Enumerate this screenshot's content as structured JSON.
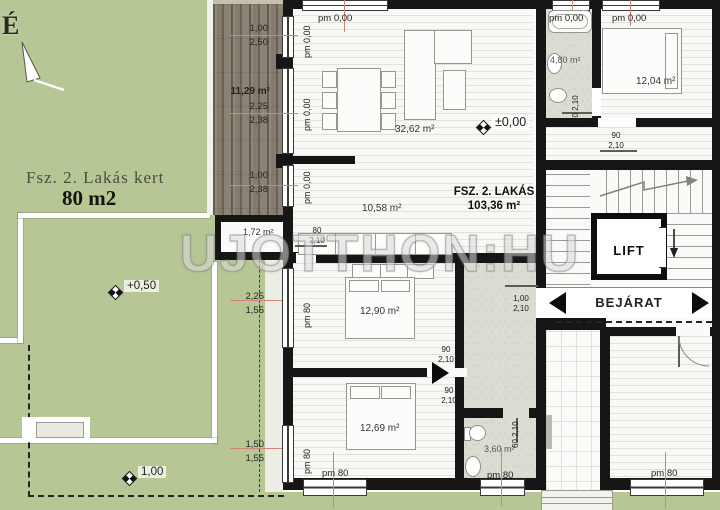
{
  "north": {
    "label": "É"
  },
  "watermark": "UJOTTHON:HU",
  "garden": {
    "title": "Fsz. 2. Lakás kert",
    "area": "80 m2",
    "level_upper": "+0,50",
    "level_lower": "1,00",
    "dim_mid": [
      "2,25",
      "1,55"
    ],
    "dim_low": [
      "1,50",
      "1,55"
    ]
  },
  "terrace": {
    "area": "11,29 m²",
    "dims_top": [
      "1,00",
      "2,50"
    ],
    "dims_mid": [
      "2,25",
      "2,38"
    ],
    "dims_low": [
      "1,00",
      "2,38"
    ]
  },
  "apartment": {
    "name": "FSZ. 2. LAKÁS",
    "total_area": "103,36 m²",
    "rooms": {
      "living": "32,62 m²",
      "hall": "10,58 m²",
      "storage": "1,72 m²",
      "bedroom1": "12,90 m²",
      "bedroom2": "12,69 m²",
      "bathroom": "3,60 m²"
    }
  },
  "neighbor": {
    "bathroom": "4,80 m²",
    "bedroom": "12,04 m²"
  },
  "levels": {
    "zero": "±0,00"
  },
  "core": {
    "lift": "LIFT",
    "entrance": "BEJÁRAT"
  },
  "window_labels": {
    "pm000": "pm 0,00",
    "pm80": "pm 80"
  },
  "door_labels": {
    "w60": "60",
    "w80": "80",
    "w90": "90",
    "w100": "1,00",
    "h": "2,10"
  },
  "colors": {
    "wall": "#161616",
    "grass": "#b4c392",
    "dim_line": "#d08377",
    "wood": "#847a6d"
  }
}
